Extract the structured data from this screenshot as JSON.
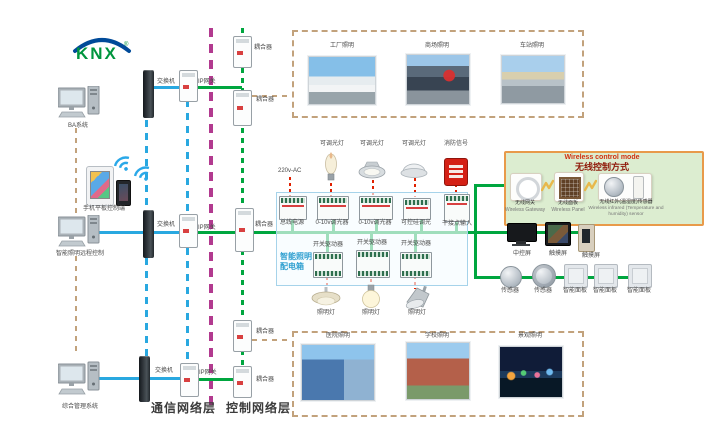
{
  "brand": {
    "name": "KNX",
    "reg": "®"
  },
  "left_column": {
    "ba_system": "BA系统",
    "mobile_label": "手机平板控制端",
    "lighting_ctrl": "智能照明远程控制",
    "mgmt_system": "综合管理系统"
  },
  "network": {
    "rows": [
      {
        "switch": "交换机",
        "gateway": "IP网关"
      },
      {
        "switch": "交换机",
        "gateway": "IP网关"
      },
      {
        "switch": "交换机",
        "gateway": "IP网关"
      }
    ],
    "couplers": [
      "耦合器",
      "耦合器",
      "耦合器",
      "耦合器",
      "耦合器"
    ],
    "layer_comm": "通信网络层",
    "layer_ctrl": "控制网络层"
  },
  "top_zone": {
    "photos": [
      "工厂照明",
      "商场照明",
      "车站照明"
    ]
  },
  "bottom_zone": {
    "photos": [
      "医院照明",
      "学校照明",
      "景观照明"
    ]
  },
  "dist_panel": {
    "name_line1": "智能照明",
    "name_line2": "配电箱",
    "power": "220v-AC",
    "loads_top": [
      "可调光灯",
      "可调光灯",
      "可调光灯",
      "消防信号"
    ],
    "modules": [
      "总线电源",
      "0-10v调光器",
      "0-10v调光器",
      "可控硅调光",
      "干接点输入"
    ],
    "actuators": [
      "开关驱动器",
      "开关驱动器",
      "开关驱动器"
    ],
    "loads_bottom": [
      "照明灯",
      "照明灯",
      "照明灯"
    ]
  },
  "wireless": {
    "title_en": "Wireless control mode",
    "title_cn": "无线控制方式",
    "items": [
      {
        "cn": "无线网关",
        "en": "Wireless Gateway"
      },
      {
        "cn": "无线面板",
        "en": "Wireless Panel"
      },
      {
        "cn": "无线红外(温湿度)传感器",
        "en": "Wireless infrared (Temperature and humidity) sensor"
      }
    ]
  },
  "control_devices": {
    "row1": [
      "中控屏",
      "触摸屏",
      "触摸屏"
    ],
    "row2": [
      "传感器",
      "传感器",
      "智能面板",
      "智能面板",
      "智能面板"
    ]
  },
  "colors": {
    "bus_green": "#00a63f",
    "lan_blue": "#29a8e0",
    "boundary_magenta": "#b23a8f",
    "load_red": "#e02000",
    "zone_tan": "#c2a27c"
  }
}
